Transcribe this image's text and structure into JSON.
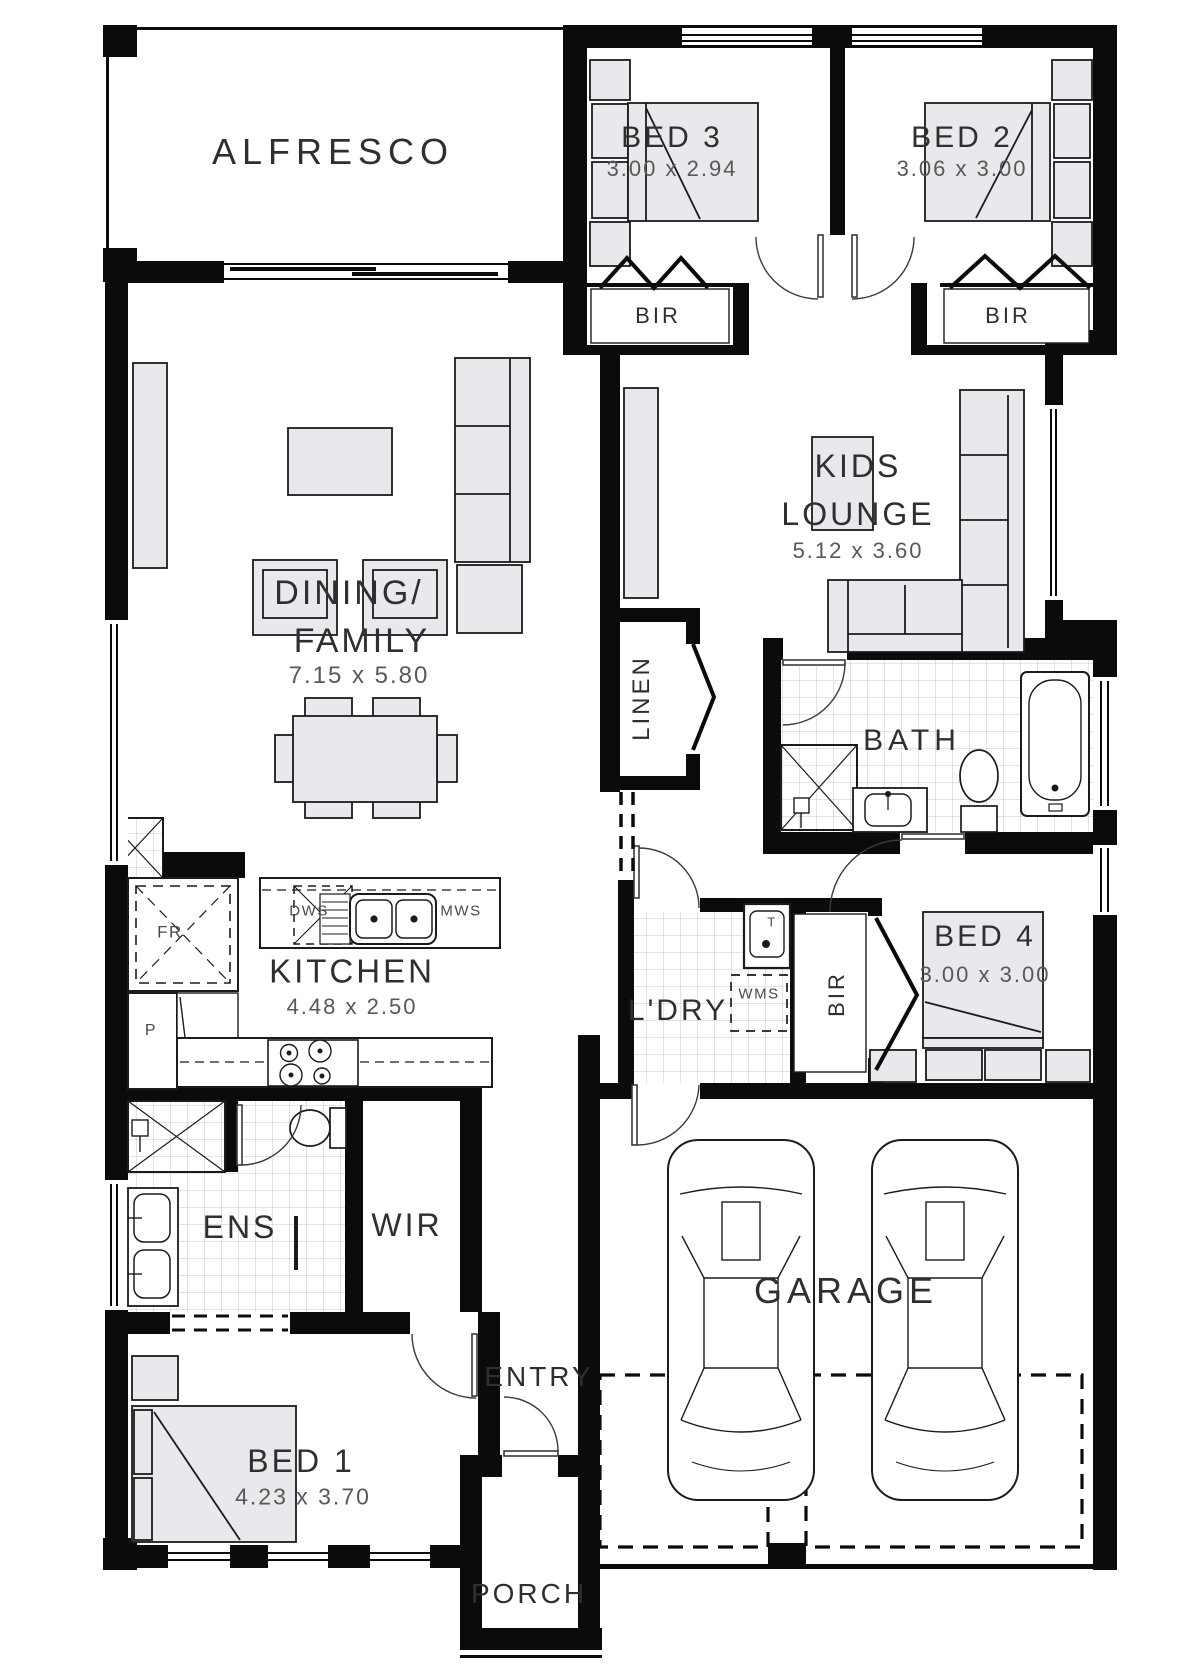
{
  "plan": {
    "type": "residential-floor-plan",
    "rooms": {
      "alfresco": {
        "name": "ALFRESCO"
      },
      "bed3": {
        "name": "BED 3",
        "dims": "3.00 x 2.94"
      },
      "bed2": {
        "name": "BED 2",
        "dims": "3.06 x 3.00"
      },
      "kids_lounge": {
        "name_line1": "KIDS",
        "name_line2": "LOUNGE",
        "dims": "5.12 x 3.60"
      },
      "dining_family": {
        "name_line1": "DINING/",
        "name_line2": "FAMILY",
        "dims": "7.15 x 5.80"
      },
      "kitchen": {
        "name": "KITCHEN",
        "dims": "4.48 x 2.50"
      },
      "bath": {
        "name": "BATH"
      },
      "linen": {
        "name": "LINEN"
      },
      "laundry": {
        "name": "L'DRY"
      },
      "bed4": {
        "name": "BED 4",
        "dims": "3.00 x 3.00"
      },
      "ens": {
        "name": "ENS"
      },
      "wir": {
        "name": "WIR"
      },
      "entry": {
        "name": "ENTRY"
      },
      "bed1": {
        "name": "BED 1",
        "dims": "4.23 x 3.70"
      },
      "porch": {
        "name": "PORCH"
      },
      "garage": {
        "name": "GARAGE"
      }
    },
    "labels": {
      "bir": "BIR",
      "wms": "WMS",
      "dws": "DWS",
      "mws": "MWS",
      "trough": "T",
      "pantry": "P",
      "fridge": "FR"
    },
    "colors": {
      "wall": "#0b0b0b",
      "furniture_fill": "#e8e9ec",
      "line": "#1b1b1b",
      "tile_line": "#c9c9c9",
      "label": "#2f2f2f",
      "dim_label": "#585858"
    }
  }
}
